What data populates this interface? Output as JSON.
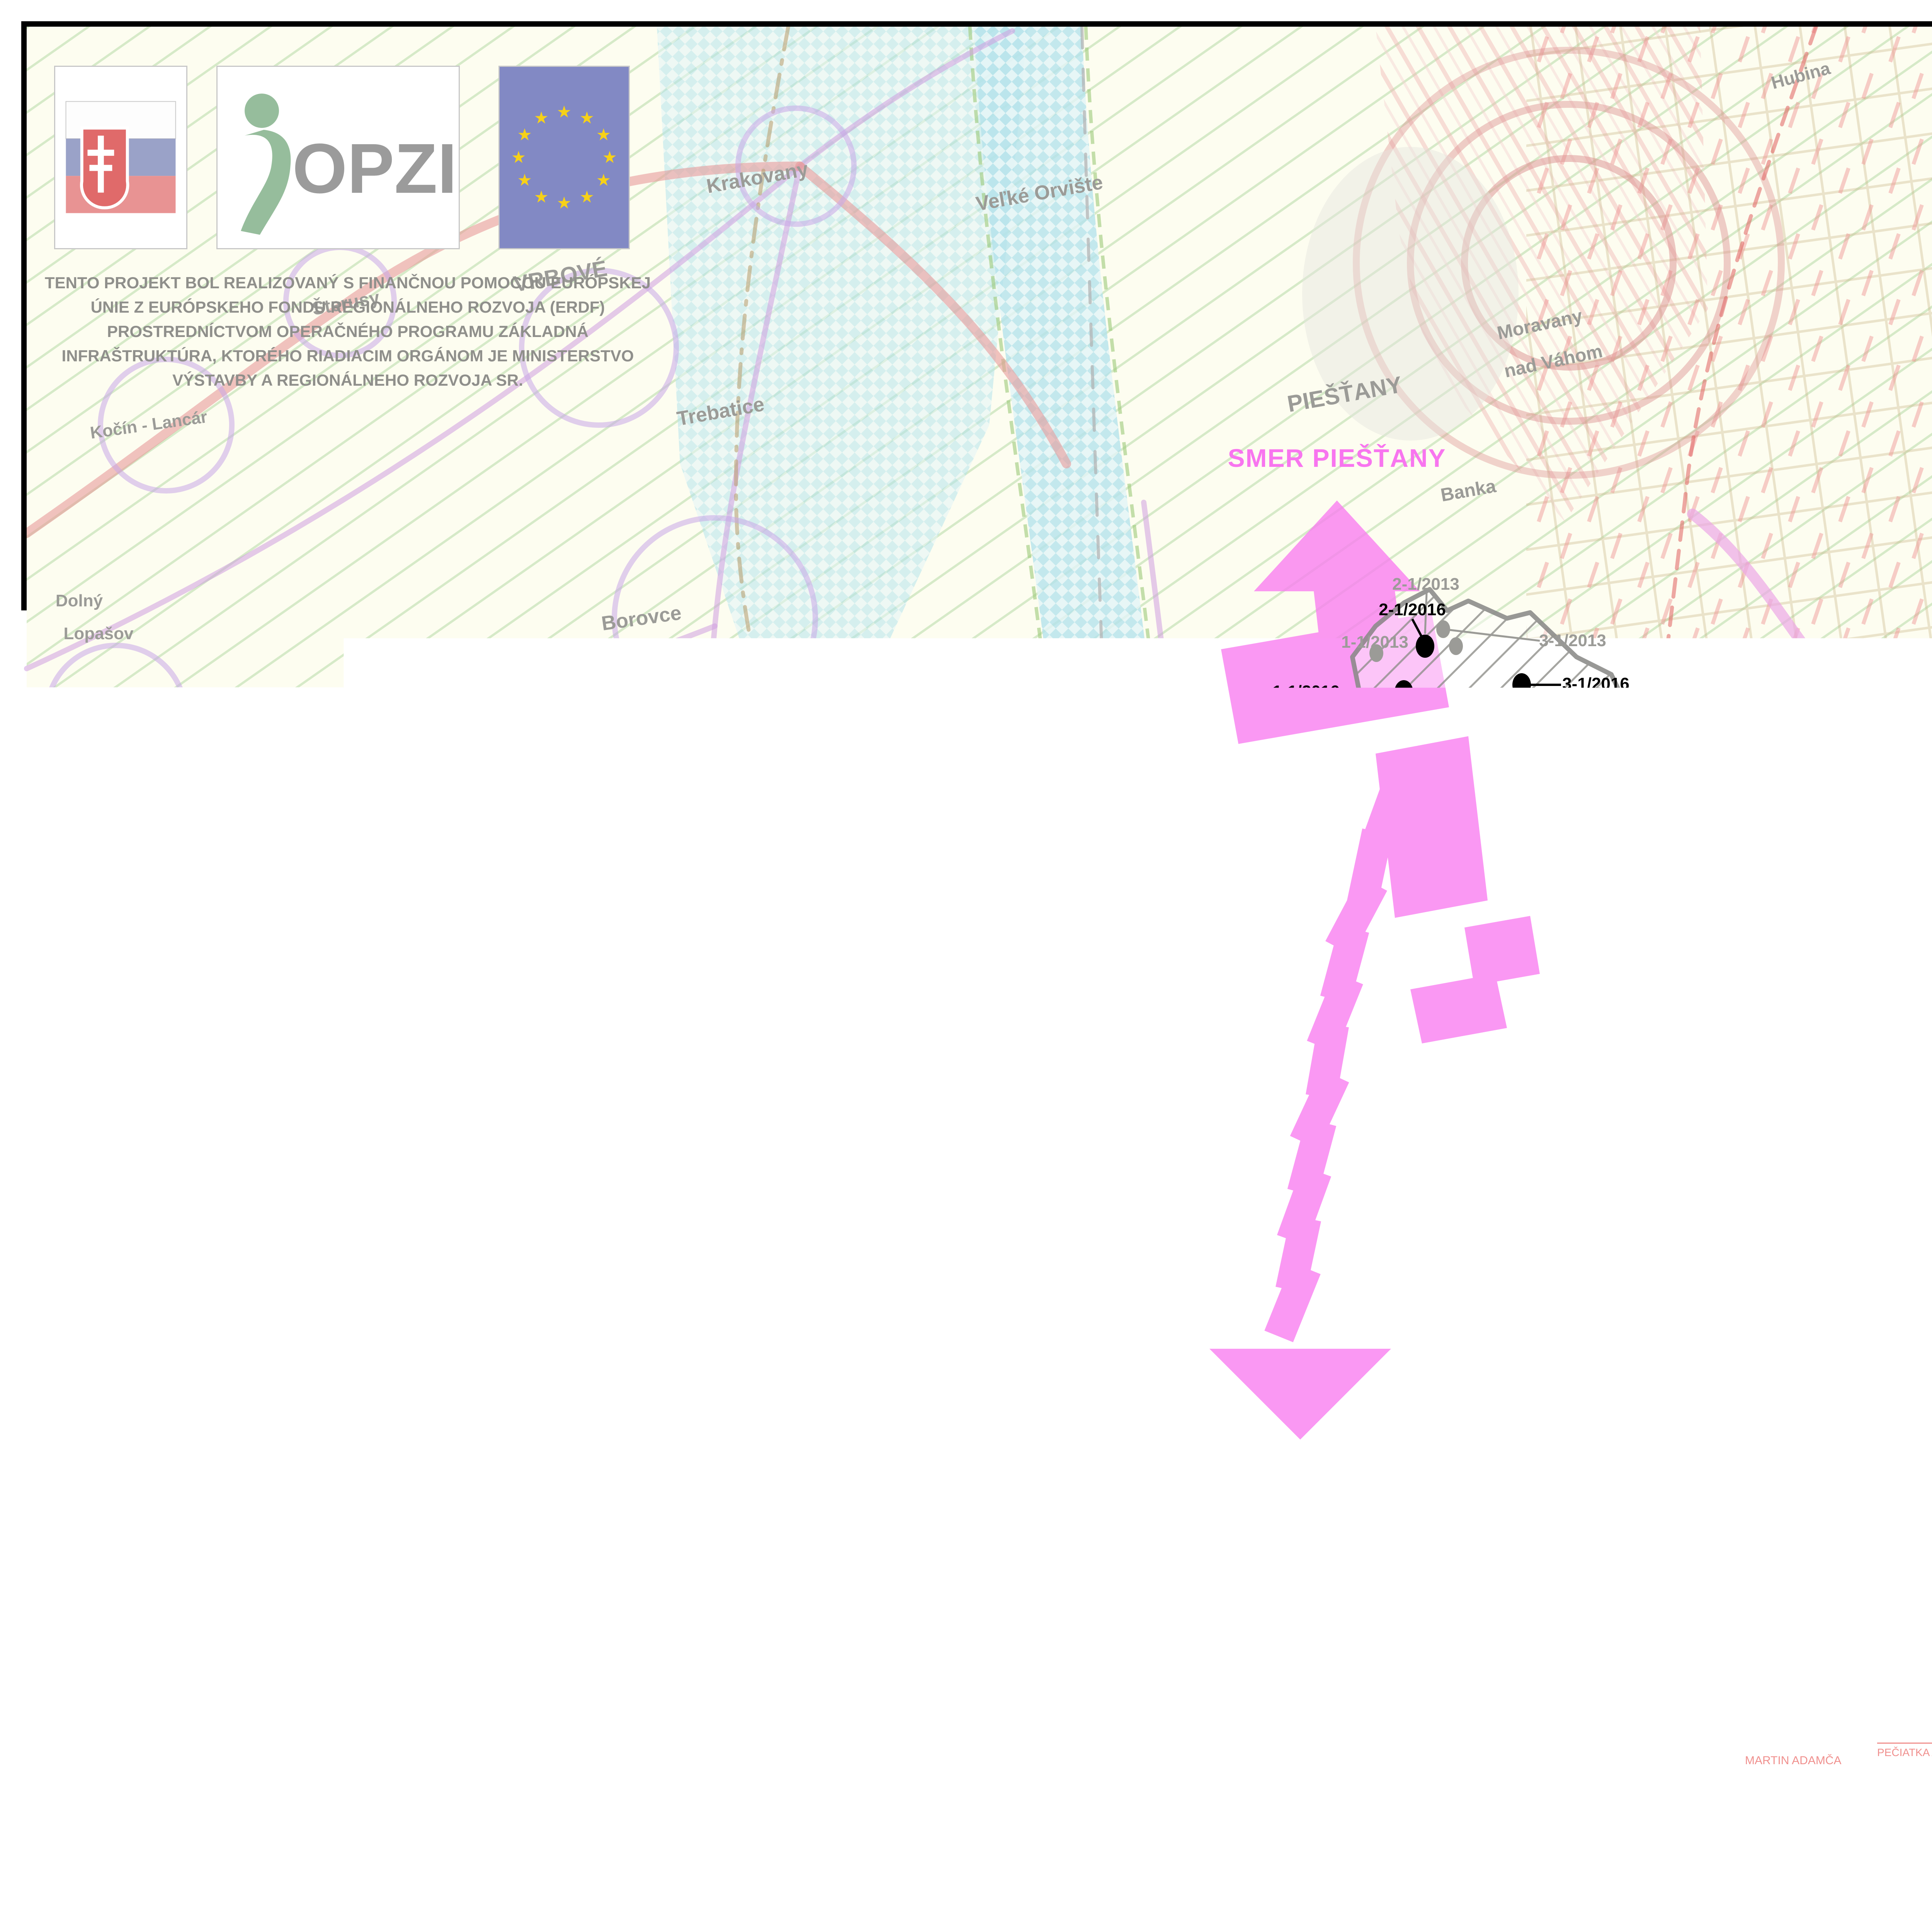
{
  "header": {
    "opzi_label": "OPZI",
    "project_text": "TENTO PROJEKT BOL REALIZOVANÝ S FINANČNOU POMOCOU EURÓPSKEJ\nÚNIE Z EURÓPSKEHO FONDU REGIONÁLNEHO ROZVOJA (ERDF)\nPROSTREDNÍCTVOM OPERAČNÉHO PROGRAMU ZÁKLADNÁ\nINFRAŠTRUKTÚRA, KTORÉHO RIADIACIM ORGÁNOM JE MINISTERSTVO\nVÝSTAVBY A REGIONÁLNEHO ROZVOJA SR."
  },
  "legend": {
    "title": "LEGENDA ZMIEN A DOPLNKOV č. 1/2016",
    "items": [
      {
        "label": "HRANICA RIEŠENÉHO ÚZEMIA"
      },
      {
        "label": "RIEŠENÉ ÚZEMIE"
      },
      {
        "label": "ZASTAVANÉ ÚZEMIE"
      },
      {
        "label": "HLAVNÉ URBANISTICKÉ VÄZBY"
      },
      {
        "label": "ZÁMERY ZMIEN A DOPLNKOV č. 1/2016",
        "swatch_tag": "1 - 1/2016"
      }
    ],
    "note": "POZNÁMKA: VÝKRES ŠIRŠÍCH VZŤAHOV JE SPRACOVANÝ DO VÝREZU VÝKRESU ZÁVÄZNÝCH ČASTÍ RIEŠENIA A VEREJNOPROSPEŠNÝCH STAVIEB PLATNÉHO ÚZEMNÉHO PLÁNU REGIÓNU TRNAVSKÉHO SAMOSPRÁVNEHO KRAJA, OBSTARÁVATEĽ: TRNAVSKÝ SAMOSPRÁVNY KRAJ, SPRACOVATEĽ: AUREX SPOL. S. R. O. , 2014."
  },
  "approval": {
    "title": "SCHVAĽOVACIA DOLOŽKA",
    "body_line1": "OBEC RATNOVCE POTVRDZUJE PLATNOSŤ ÚZEMNO-PLÁNOVACEJ DOKUMENTÁCIE",
    "body_line2": "V ZMYSLE UZNESENIA OZ č. 26/2017 V RATNOVCIACH ZO DŇA 28. 8. 2017.",
    "mayor_label": "STAROSTA OBCE:",
    "mayor_name": "Peter Gogol",
    "stamp_label": "PEČIATKA A PODPIS:"
  },
  "stamp": {
    "title": "OBEC RATNOVCE",
    "line1": "POTVRDZUJE PLATNOSŤ",
    "line2": "ÚZEMNO - PLÁNOVACEJ DOKUMENTÁCIE",
    "line3": "V ZMYSLE UZNESENIA OZ V RATNOVCIACH Č. ...",
    "line4": "ZO DŇA ...........................",
    "mayor_label": "STAROSTA OBCE:",
    "mayor_name": "MARTIN ADAMČA",
    "stamp_label": "PEČIATKA A PODPIS:"
  },
  "scalebar": {
    "zero": "0",
    "l500": "500m",
    "l1000": "1000m",
    "l2000": "2000m",
    "scale": "M 1 : 50  000"
  },
  "titlebar": {
    "spracovatel_label": "SPRACOVATEĽ:",
    "spracovatel_name": "ÚPn s.r.o.,",
    "spracovatel_addr": "DROTÁRSKA CESTA 37, 811 02 BRATISLAVA",
    "doc_title": "ÚZEMNÝ PLÁN OBCE RATNOVCE",
    "doc_subtitle": "ZMENY A DOPLNKY č. 1/2016",
    "doc_subtitle_red": "ČISTOPIS",
    "obstaravatel_label": "OBSTARÁVATEĽ :",
    "obstaravatel_name": "OBEC RATNOVCE,",
    "obstaravatel_addr": "OÚ RATNOVCE 152, 922 31 SOKOLOVCE",
    "sheet_title": "VÝKRES ŠIRŠÍCH VZŤAHOV",
    "sheet_number": "1"
  },
  "map": {
    "source_note": "SPRACOVANÉ DO PODKLADU PREVZATÉHO Z ÚPN VÚC TRNAVSKÝ KRAJ - ZMENY A DOPLNKY 2006, SPRACOVATEĽ AUREX S.R.O.",
    "direction_north": "SMER PIEŠŤANY",
    "direction_south": "SMER HLOHOVEC, TRNAVA",
    "labels": [
      {
        "text": "Hubina"
      },
      {
        "text": "Krakovany"
      },
      {
        "text": "Veľké Orvište"
      },
      {
        "text": "Moravany"
      },
      {
        "text": "nad Váhom"
      },
      {
        "text": "VRBOVÉ"
      },
      {
        "text": "Šterusy"
      },
      {
        "text": "Kočín - Lancár"
      },
      {
        "text": "PIEŠŤANY"
      },
      {
        "text": "Trebatice"
      },
      {
        "text": "Banka"
      },
      {
        "text": "Dolný"
      },
      {
        "text": "Lopašov"
      },
      {
        "text": "Borovce"
      },
      {
        "text": "Rakovice"
      },
      {
        "text": "Veselé"
      },
      {
        "text": "Nižná"
      },
      {
        "text": "Dubovany"
      },
      {
        "text": "Veľké"
      },
      {
        "text": "Kostoľany"
      },
      {
        "text": "ošovce"
      },
      {
        "text": "Pečeňady"
      },
      {
        "text": "vské"
      },
      {
        "text": "nice"
      },
      {
        "text": "Ratkovce"
      },
      {
        "text": "Červeník"
      },
      {
        "text": "Žlkovce"
      },
      {
        "text": "Drahovce"
      },
      {
        "text": "Madunice"
      },
      {
        "text": "Koplotovce"
      },
      {
        "text": "Jalšové"
      },
      {
        "text": "Sokolovce"
      },
      {
        "text": "Ardanovce"
      },
      {
        "text": "Šalgovce"
      },
      {
        "text": "Svrbice"
      },
      {
        "text": "Bz"
      },
      {
        "text": "Orešany"
      },
      {
        "text": "Teko"
      },
      {
        "text": "Horné"
      },
      {
        "text": "Otrokovce"
      },
      {
        "text": "RATNOVCE"
      }
    ],
    "changes_2016": [
      {
        "text": "2-1/2016"
      },
      {
        "text": "1-1/2016"
      },
      {
        "text": "3-1/2016"
      },
      {
        "text": "4-1/2016"
      },
      {
        "text": "6-1/2016"
      },
      {
        "text": "5-1/2016"
      }
    ],
    "changes_2013": [
      {
        "text": "2-1/2013"
      },
      {
        "text": "1-1/2013"
      },
      {
        "text": "3-1/2013"
      },
      {
        "text": "4-1/2013"
      },
      {
        "text": "7-1/2013"
      },
      {
        "text": "5-1/2013"
      },
      {
        "text": "6-1/2013"
      },
      {
        "text": "8-1/2013"
      },
      {
        "text": "9-1/2013"
      },
      {
        "text": "10-1/2013"
      }
    ]
  },
  "colors": {
    "magenta": "#f97bf0",
    "built_up": "#9c686a",
    "approval_red": "#ee1111",
    "stamp_pink": "#f0908e"
  }
}
